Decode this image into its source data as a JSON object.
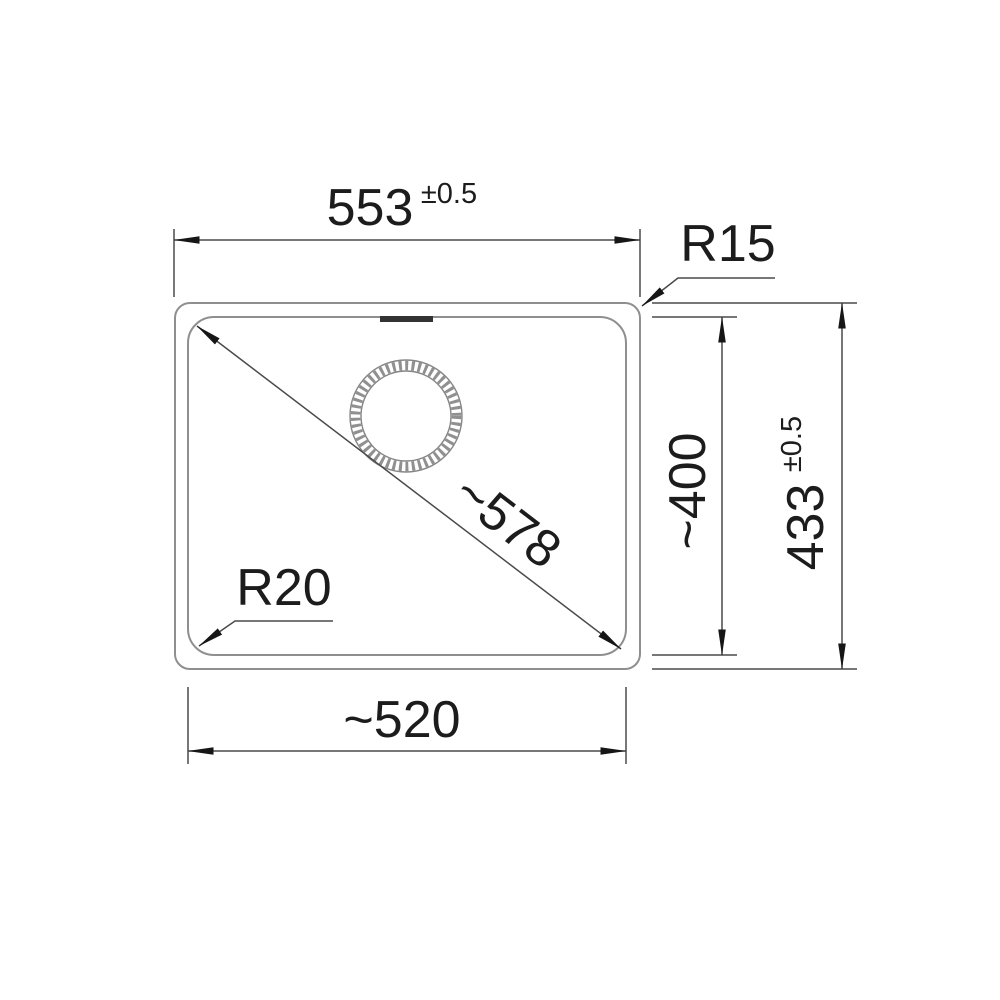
{
  "drawing": {
    "type": "technical-dimension-drawing",
    "subject": "sink-bowl-top-view",
    "labels": {
      "width_top": "553",
      "width_top_tol": "±0.5",
      "radius_outer": "R15",
      "diagonal": "~578",
      "radius_inner": "R20",
      "width_bottom": "~520",
      "height_inner": "~400",
      "height_outer": "433",
      "height_outer_tol": "±0.5"
    },
    "colors": {
      "background": "#ffffff",
      "outline": "#8f8f8f",
      "dimension_lines": "#4a4a4a",
      "arrowheads": "#161616",
      "text": "#1c1c1c",
      "overflow_mark": "#333333"
    }
  }
}
